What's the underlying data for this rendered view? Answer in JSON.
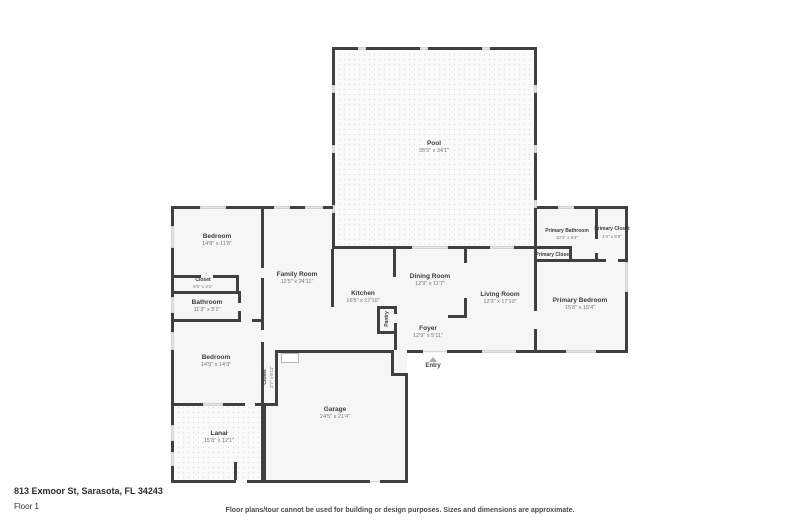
{
  "footer": {
    "address": "813 Exmoor St, Sarasota, FL 34243",
    "floor_label": "Floor 1",
    "disclaimer": "Floor plans/tour cannot be used for building or design purposes. Sizes and dimensions are approximate."
  },
  "rooms": {
    "pool": {
      "name": "Pool",
      "dims": "35'5\" x 34'1\""
    },
    "bedroom1": {
      "name": "Bedroom",
      "dims": "14'8\" x 11'8\""
    },
    "closet1": {
      "name": "Closet",
      "dims": "9'6\" x 2'1\""
    },
    "bathroom": {
      "name": "Bathroom",
      "dims": "11'3\" x 5'1\""
    },
    "family_room": {
      "name": "Family Room",
      "dims": "12'5\" x 24'11\""
    },
    "kitchen": {
      "name": "Kitchen",
      "dims": "16'5\" x 17'10\""
    },
    "pantry": {
      "name": "Pantry"
    },
    "dining_room": {
      "name": "Dining Room",
      "dims": "12'9\" x 11'7\""
    },
    "living_room": {
      "name": "Living Room",
      "dims": "12'3\" x 17'10\""
    },
    "primary_bathroom": {
      "name": "Primary Bathroom",
      "dims": "10'4\" x 6'4\""
    },
    "primary_closet_side": {
      "name": "Primary Closet",
      "dims": "4'4\" x 8'9\""
    },
    "primary_closet_small": {
      "name": "Primary Closet"
    },
    "primary_bedroom": {
      "name": "Primary Bedroom",
      "dims": "15'8\" x 15'4\""
    },
    "foyer": {
      "name": "Foyer",
      "dims": "12'9\" x 5'11\""
    },
    "entry": {
      "name": "Entry"
    },
    "bedroom2": {
      "name": "Bedroom",
      "dims": "14'9\" x 14'3\""
    },
    "closet2": {
      "name": "Closet",
      "dims": "2'7\" x 8'11\""
    },
    "garage": {
      "name": "Garage",
      "dims": "24'5\" x 21'4\""
    },
    "lanai": {
      "name": "Lanai",
      "dims": "15'8\" x 12'1\""
    }
  },
  "colors": {
    "wall": "#404040",
    "room_fill": "#f6f6f6",
    "label_text": "#3d3d3d",
    "dims_text": "#767676"
  }
}
